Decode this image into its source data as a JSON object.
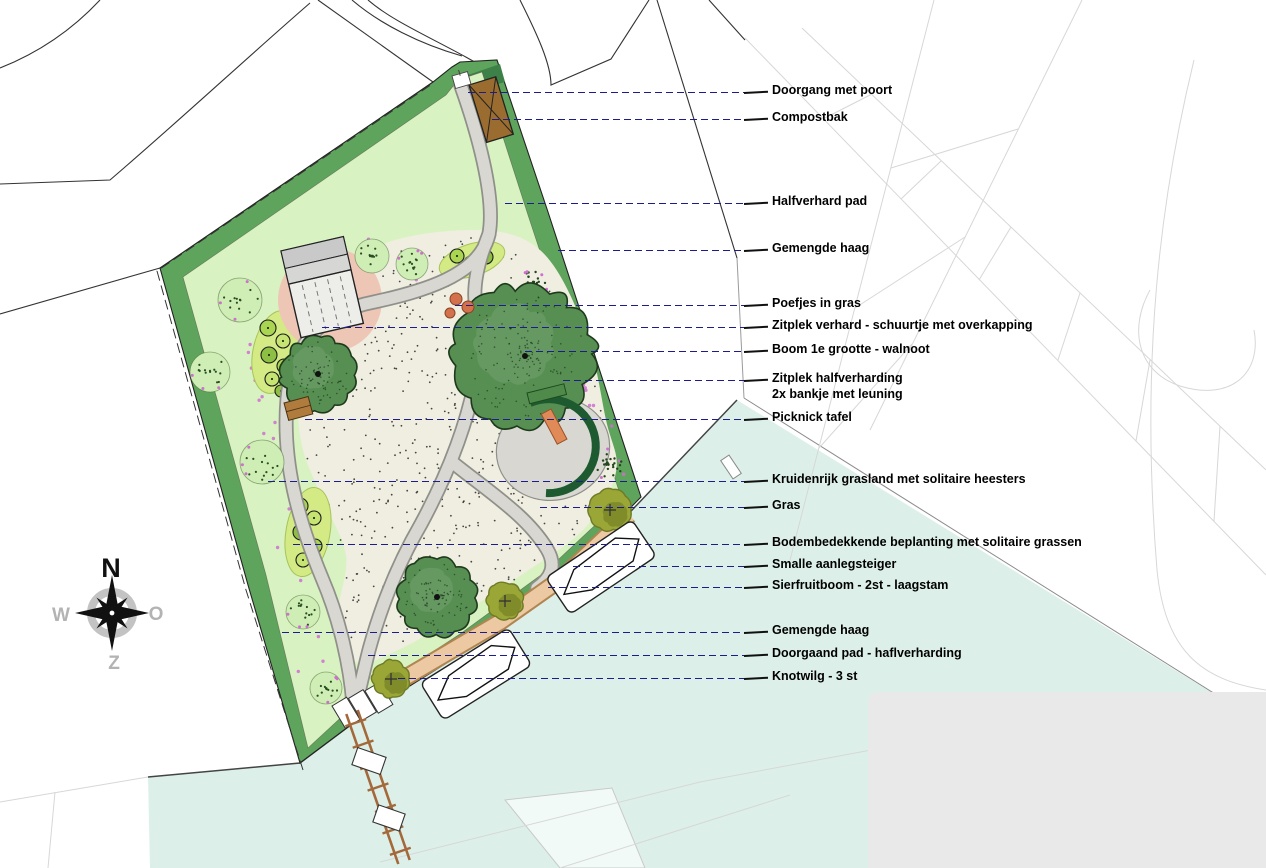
{
  "compass": {
    "north": "N",
    "east": "O",
    "south": "Z",
    "west": "W"
  },
  "annotations": {
    "items": [
      {
        "label": "Doorgang met poort"
      },
      {
        "label": "Compostbak"
      },
      {
        "label": "Halfverhard pad"
      },
      {
        "label": "Gemengde haag"
      },
      {
        "label": "Poefjes in gras"
      },
      {
        "label": "Zitplek verhard - schuurtje met overkapping"
      },
      {
        "label": "Boom 1e grootte - walnoot"
      },
      {
        "label": "Zitplek halfverharding",
        "label2": "2x bankje met leuning"
      },
      {
        "label": "Picknick tafel"
      },
      {
        "label": "Kruidenrijk grasland met solitaire heesters"
      },
      {
        "label": "Gras"
      },
      {
        "label": "Bodembedekkende beplanting met solitaire grassen"
      },
      {
        "label": "Smalle aanlegsteiger"
      },
      {
        "label": "Sierfruitboom - 2st - laagstam"
      },
      {
        "label": "Gemengde haag"
      },
      {
        "label": "Doorgaand pad - haflverharding"
      },
      {
        "label": "Knotwilg - 3 st"
      }
    ]
  },
  "colors": {
    "hedge": "#5fa45c",
    "hedge_dark": "#3e8148",
    "grass": "#d9f2c2",
    "meadow": "#efeee1",
    "path": "#d8d7d1",
    "path_edge": "#90908a",
    "salmon": "#ecc9a2",
    "salmon_edge": "#b08550",
    "water": "#dcf0e9",
    "water_line": "#444444",
    "pink_circle": "#eec6b6",
    "tree": "#578f52",
    "tree_outline": "#1e3a1c",
    "olive": "#9aa636",
    "bed": "#d4ea85",
    "shrub": "#cfeeb5",
    "flower_pink": "#cf6fd0",
    "leader": "#1c1c8e",
    "compost": "#9b6c30",
    "bench_orange": "#e08a58",
    "bench_green": "#4f8a4a",
    "arc_green": "#1d5a30",
    "table_brown": "#b07c3e",
    "pouf": "#d4714d",
    "panel": "#e9e9e9",
    "parcel_line": "#d7d7d7",
    "outline": "#333333",
    "compass_gray": "#b3b3b3"
  }
}
